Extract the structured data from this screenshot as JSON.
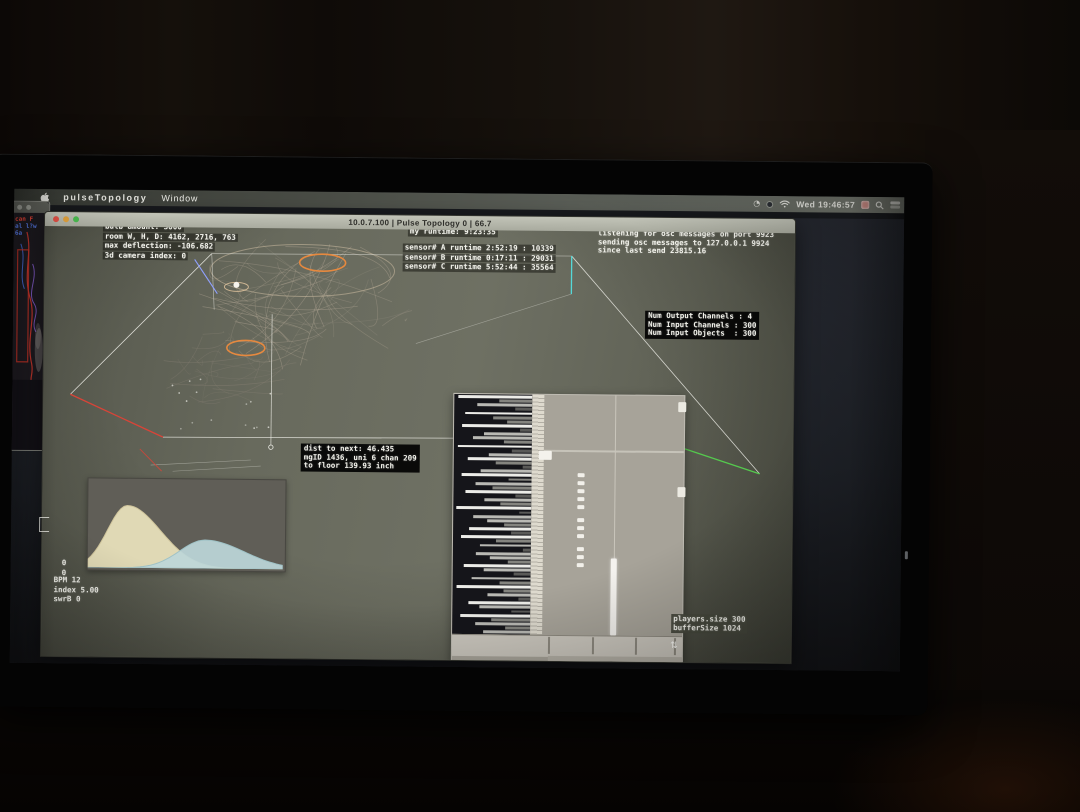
{
  "colors": {
    "accent_orange": "#e6893f",
    "edge_red": "#d84438",
    "edge_green": "#55c94e",
    "edge_cyan": "#55d8d8",
    "edge_blue": "#8fa0ff",
    "window_bg": "#686a5d"
  },
  "menu_bar": {
    "app_name": "pulseTopology",
    "menu_item": "Window",
    "clock": "Wed 19:46:57"
  },
  "app_window": {
    "title": "10.0.7.100 | Pulse Topology 0 | 66.7"
  },
  "hud": {
    "bulb_block": [
      "bulb amount: 3000",
      "room W, H, D: 4162, 2716, 763",
      "max deflection: -106.682",
      "3d camera index: 0"
    ],
    "runtime_block": [
      "my runtime: 9:23:35"
    ],
    "sensor_block": [
      "sensor# A runtime 2:52:19 : 10339",
      "sensor# B runtime 0:17:11 : 29031",
      "sensor# C runtime 5:52:44 : 35564"
    ],
    "osc_block": [
      "listening for osc messages on port 9923",
      "sending osc messages to 127.0.0.1 9924",
      "since last send 23815.16"
    ],
    "channels_block": [
      "Num Output Channels : 4",
      "Num Input Channels : 300",
      "Num Input Objects  : 300"
    ],
    "dist_block": [
      "dist to next: 46.435",
      "mgID 1436, uni 6 chan 209",
      "to floor 139.93 inch"
    ],
    "counter_block": [
      "0",
      "0"
    ],
    "stats_block": [
      "BPM 12",
      "index 5.00",
      "swrB 0"
    ],
    "audio_stats_block": [
      "players.size 300",
      "bufferSize 1024"
    ]
  },
  "left_window": {
    "lines": [
      "can F",
      "al l?w",
      "6a"
    ]
  },
  "audio_panel": {
    "transport": [
      "▶",
      "■",
      "⊓",
      "●"
    ],
    "meter_bars": [
      0.95,
      0.42,
      0.7,
      0.22,
      0.86,
      0.5,
      0.32,
      0.9,
      0.15,
      0.62,
      0.76,
      0.36,
      0.95,
      0.26,
      0.55,
      0.82,
      0.46,
      0.12,
      0.66,
      0.9,
      0.3,
      0.72,
      0.5,
      0.85,
      0.2,
      0.6,
      0.4,
      0.96,
      0.16,
      0.75,
      0.56,
      0.34,
      0.8,
      0.26,
      0.9,
      0.45,
      0.66,
      0.1,
      0.7,
      0.52,
      0.3,
      0.86,
      0.6,
      0.22,
      0.76,
      0.4,
      0.95,
      0.35,
      0.55,
      0.15,
      0.8,
      0.65,
      0.25,
      0.9,
      0.5,
      0.7,
      0.32,
      0.6
    ]
  },
  "chart_data": {
    "type": "area",
    "title": "",
    "xlabel": "",
    "ylabel": "",
    "note": "two overlapping smoothed distribution curves, no axes shown",
    "series": [
      {
        "name": "distribution-a",
        "color": "#ece4bd",
        "outline": "#cfc49b",
        "peak_x": 0.2,
        "peak_height": 0.7,
        "peak_wl": 0.1,
        "peak_wr": 0.17
      },
      {
        "name": "distribution-b",
        "color": "#bdd7d9",
        "outline": "#9fc2c6",
        "peak_x": 0.6,
        "peak_height": 0.32,
        "peak_wl": 0.13,
        "peak_wr": 0.2
      }
    ]
  }
}
